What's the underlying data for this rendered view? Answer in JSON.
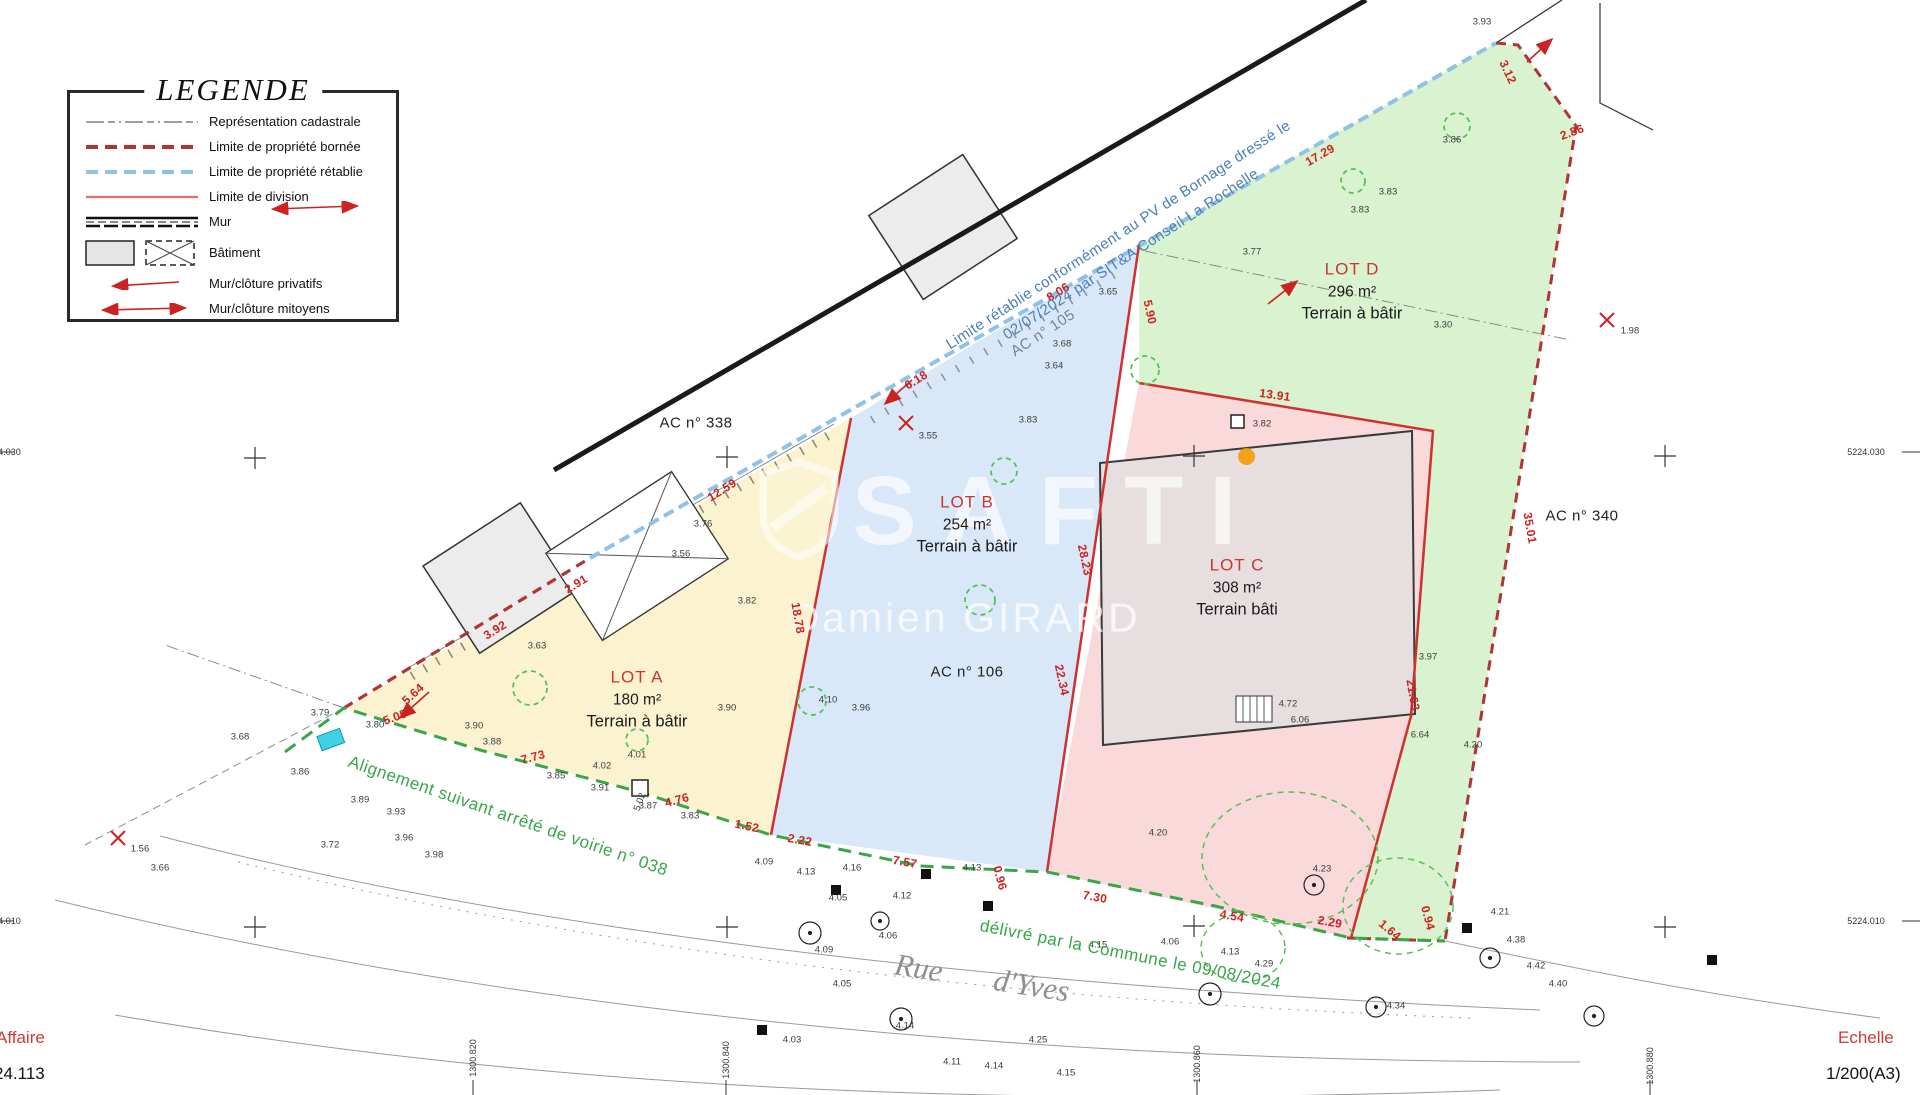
{
  "legend": {
    "title": "LEGENDE",
    "items": [
      {
        "label": "Représentation cadastrale"
      },
      {
        "label": "Limite de propriété bornée"
      },
      {
        "label": "Limite de propriété rétablie"
      },
      {
        "label": "Limite de division"
      },
      {
        "label": "Mur"
      },
      {
        "label": "Bâtiment"
      },
      {
        "label": "Mur/clôture privatifs"
      },
      {
        "label": "Mur/clôture mitoyens"
      }
    ]
  },
  "lots": [
    {
      "name": "LOT A",
      "area": "180 m²",
      "type": "Terrain à bâtir",
      "color": "#fbf3cf",
      "x": 637,
      "y": 700
    },
    {
      "name": "LOT B",
      "area": "254 m²",
      "type": "Terrain à bâtir",
      "color": "#d9e8f8",
      "x": 967,
      "y": 525
    },
    {
      "name": "LOT C",
      "area": "308 m²",
      "type": "Terrain bâti",
      "color": "#f9d9da",
      "x": 1237,
      "y": 588
    },
    {
      "name": "LOT D",
      "area": "296 m²",
      "type": "Terrain à bâtir",
      "color": "#d9f2d0",
      "x": 1352,
      "y": 292
    }
  ],
  "parcels": [
    {
      "t": "AC n° 338",
      "x": 696,
      "y": 423,
      "r": 0,
      "s": 15
    },
    {
      "t": "AC n° 105",
      "x": 1043,
      "y": 333,
      "r": -33,
      "s": 15,
      "c": "#72839b"
    },
    {
      "t": "AC n° 106",
      "x": 967,
      "y": 672,
      "r": 0,
      "s": 15
    },
    {
      "t": "AC n° 340",
      "x": 1582,
      "y": 516,
      "r": 0,
      "s": 15
    }
  ],
  "annotations": {
    "blue_line1": "Limite rétablie conformément au PV de Bornage dressé le",
    "blue_line2": "02/07/2024 par SIT&A Conseil  La Rochelle",
    "alignment": "Alignement suivant arrêté de voirie n° 038",
    "delivered": "délivré par la Commune le 09/08/2024",
    "street_word1": "Rue",
    "street_word2": "d'Yves"
  },
  "watermark": {
    "brand": "SAFTI",
    "agent": "Damien GIRARD",
    "dot_color": "#f59b00"
  },
  "titleblock": {
    "affaire_label": "Affaire",
    "affaire_value": "24.113",
    "echelle_label": "Echelle",
    "echelle_value": "1/200(A3)"
  },
  "dims": [
    {
      "t": "2.91",
      "x": 576,
      "y": 584,
      "r": -32
    },
    {
      "t": "3.92",
      "x": 495,
      "y": 630,
      "r": -32
    },
    {
      "t": "5.64",
      "x": 413,
      "y": 694,
      "r": -42
    },
    {
      "t": "5.05",
      "x": 395,
      "y": 717,
      "r": -20
    },
    {
      "t": "7.73",
      "x": 533,
      "y": 757,
      "r": -15
    },
    {
      "t": "4.76",
      "x": 677,
      "y": 800,
      "r": -15
    },
    {
      "t": "1.52",
      "x": 747,
      "y": 826,
      "r": 12
    },
    {
      "t": "2.22",
      "x": 800,
      "y": 840,
      "r": 10
    },
    {
      "t": "7.57",
      "x": 905,
      "y": 862,
      "r": 10
    },
    {
      "t": "0.96",
      "x": 1000,
      "y": 878,
      "r": 75
    },
    {
      "t": "7.30",
      "x": 1095,
      "y": 897,
      "r": 10
    },
    {
      "t": "4.54",
      "x": 1232,
      "y": 916,
      "r": 10
    },
    {
      "t": "2.29",
      "x": 1330,
      "y": 922,
      "r": 10
    },
    {
      "t": "1.64",
      "x": 1390,
      "y": 930,
      "r": 40
    },
    {
      "t": "0.94",
      "x": 1428,
      "y": 918,
      "r": 75
    },
    {
      "t": "12.59",
      "x": 722,
      "y": 490,
      "r": -32
    },
    {
      "t": "6.18",
      "x": 916,
      "y": 380,
      "r": -32
    },
    {
      "t": "8.06",
      "x": 1058,
      "y": 292,
      "r": -32
    },
    {
      "t": "5.90",
      "x": 1150,
      "y": 312,
      "r": 78
    },
    {
      "t": "17.29",
      "x": 1320,
      "y": 155,
      "r": -30
    },
    {
      "t": "13.91",
      "x": 1275,
      "y": 395,
      "r": 8
    },
    {
      "t": "18.78",
      "x": 798,
      "y": 618,
      "r": 80
    },
    {
      "t": "28.23",
      "x": 1085,
      "y": 560,
      "r": 78
    },
    {
      "t": "22.34",
      "x": 1062,
      "y": 680,
      "r": 78
    },
    {
      "t": "21.63",
      "x": 1413,
      "y": 695,
      "r": 80
    },
    {
      "t": "35.01",
      "x": 1530,
      "y": 528,
      "r": 80
    },
    {
      "t": "3.12",
      "x": 1508,
      "y": 72,
      "r": 65
    },
    {
      "t": "2.86",
      "x": 1572,
      "y": 132,
      "r": -20
    }
  ],
  "spots": [
    {
      "t": "3.93",
      "x": 1482,
      "y": 22
    },
    {
      "t": "3.86",
      "x": 1452,
      "y": 140
    },
    {
      "t": "3.83",
      "x": 1388,
      "y": 192
    },
    {
      "t": "3.77",
      "x": 1252,
      "y": 252
    },
    {
      "t": "3.65",
      "x": 1108,
      "y": 292
    },
    {
      "t": "3.68",
      "x": 1062,
      "y": 344
    },
    {
      "t": "3.64",
      "x": 1054,
      "y": 366
    },
    {
      "t": "3.30",
      "x": 1443,
      "y": 325
    },
    {
      "t": "3.83",
      "x": 1360,
      "y": 210
    },
    {
      "t": "3.97",
      "x": 1428,
      "y": 657
    },
    {
      "t": "3.83",
      "x": 1028,
      "y": 420
    },
    {
      "t": "3.82",
      "x": 1262,
      "y": 424
    },
    {
      "t": "3.56",
      "x": 681,
      "y": 554
    },
    {
      "t": "3.76",
      "x": 703,
      "y": 524
    },
    {
      "t": "3.82",
      "x": 747,
      "y": 601
    },
    {
      "t": "3.90",
      "x": 727,
      "y": 708
    },
    {
      "t": "3.96",
      "x": 861,
      "y": 708
    },
    {
      "t": "4.10",
      "x": 828,
      "y": 700
    },
    {
      "t": "3.63",
      "x": 537,
      "y": 646
    },
    {
      "t": "4.01",
      "x": 637,
      "y": 755
    },
    {
      "t": "4.02",
      "x": 602,
      "y": 766
    },
    {
      "t": "5.02",
      "x": 640,
      "y": 802,
      "r": -70
    },
    {
      "t": "3.88",
      "x": 492,
      "y": 742
    },
    {
      "t": "3.90",
      "x": 474,
      "y": 726
    },
    {
      "t": "3.80",
      "x": 375,
      "y": 725
    },
    {
      "t": "3.79",
      "x": 320,
      "y": 713
    },
    {
      "t": "3.68",
      "x": 240,
      "y": 737
    },
    {
      "t": "3.86",
      "x": 300,
      "y": 772
    },
    {
      "t": "3.89",
      "x": 360,
      "y": 800
    },
    {
      "t": "3.93",
      "x": 396,
      "y": 812
    },
    {
      "t": "3.72",
      "x": 330,
      "y": 845
    },
    {
      "t": "3.66",
      "x": 160,
      "y": 868
    },
    {
      "t": "3.96",
      "x": 404,
      "y": 838
    },
    {
      "t": "3.98",
      "x": 434,
      "y": 855
    },
    {
      "t": "3.85",
      "x": 556,
      "y": 776
    },
    {
      "t": "3.91",
      "x": 600,
      "y": 788
    },
    {
      "t": "3.87",
      "x": 648,
      "y": 806
    },
    {
      "t": "3.83",
      "x": 690,
      "y": 816
    },
    {
      "t": "4.09",
      "x": 764,
      "y": 862
    },
    {
      "t": "4.13",
      "x": 806,
      "y": 872
    },
    {
      "t": "4.16",
      "x": 852,
      "y": 868
    },
    {
      "t": "4.05",
      "x": 838,
      "y": 898
    },
    {
      "t": "4.12",
      "x": 902,
      "y": 896
    },
    {
      "t": "4.13",
      "x": 972,
      "y": 868
    },
    {
      "t": "4.06",
      "x": 888,
      "y": 936
    },
    {
      "t": "4.09",
      "x": 824,
      "y": 950
    },
    {
      "t": "4.05",
      "x": 842,
      "y": 984
    },
    {
      "t": "4.14",
      "x": 905,
      "y": 1026
    },
    {
      "t": "4.03",
      "x": 792,
      "y": 1040
    },
    {
      "t": "4.11",
      "x": 952,
      "y": 1062
    },
    {
      "t": "4.14",
      "x": 994,
      "y": 1066
    },
    {
      "t": "4.15",
      "x": 1066,
      "y": 1073
    },
    {
      "t": "4.25",
      "x": 1038,
      "y": 1040
    },
    {
      "t": "4.15",
      "x": 1098,
      "y": 945
    },
    {
      "t": "4.06",
      "x": 1170,
      "y": 942
    },
    {
      "t": "4.13",
      "x": 1230,
      "y": 952
    },
    {
      "t": "4.29",
      "x": 1264,
      "y": 964
    },
    {
      "t": "4.20",
      "x": 1158,
      "y": 833
    },
    {
      "t": "4.20",
      "x": 1473,
      "y": 745
    },
    {
      "t": "4.23",
      "x": 1322,
      "y": 869
    },
    {
      "t": "4.21",
      "x": 1500,
      "y": 912
    },
    {
      "t": "4.38",
      "x": 1516,
      "y": 940
    },
    {
      "t": "4.42",
      "x": 1536,
      "y": 966
    },
    {
      "t": "4.40",
      "x": 1558,
      "y": 984
    },
    {
      "t": "4.34",
      "x": 1396,
      "y": 1006
    },
    {
      "t": "4.72",
      "x": 1288,
      "y": 704
    },
    {
      "t": "6.06",
      "x": 1300,
      "y": 720
    },
    {
      "t": "6.64",
      "x": 1420,
      "y": 735
    },
    {
      "t": "3.55",
      "x": 928,
      "y": 436
    },
    {
      "t": "1.56",
      "x": 140,
      "y": 849
    },
    {
      "t": "1.98",
      "x": 1630,
      "y": 331
    }
  ],
  "grid": {
    "edge_labels": [
      {
        "t": "5224.030",
        "x": 1866,
        "y": 452
      },
      {
        "t": "5224.010",
        "x": 1866,
        "y": 921
      },
      {
        "t": "5224.030",
        "x": 2,
        "y": 452
      },
      {
        "t": "5224.010",
        "x": 2,
        "y": 921
      }
    ],
    "bottom_labels": [
      {
        "t": "1300.820",
        "x": 473,
        "y": 1058,
        "r": -90
      },
      {
        "t": "1300.840",
        "x": 726,
        "y": 1060,
        "r": -90
      },
      {
        "t": "1300.860",
        "x": 1197,
        "y": 1064,
        "r": -90
      },
      {
        "t": "1300.880",
        "x": 1650,
        "y": 1066,
        "r": -90
      }
    ]
  },
  "colors": {
    "lot_a": "#fbf3cf",
    "lot_b": "#d9e8f8",
    "lot_c": "#f9d9da",
    "lot_d": "#d9f2d0",
    "boundary_red": "#b03434",
    "division_red": "#d03030",
    "retablie_blue": "#8fc1e9",
    "alignment_green": "#3aa549",
    "annotation_blue": "#4a7fb5",
    "dim_red": "#cc2222",
    "tree_green": "#58c05a",
    "cyan_marker": "#3fd2e6",
    "watermark_orange": "#f59b00"
  }
}
